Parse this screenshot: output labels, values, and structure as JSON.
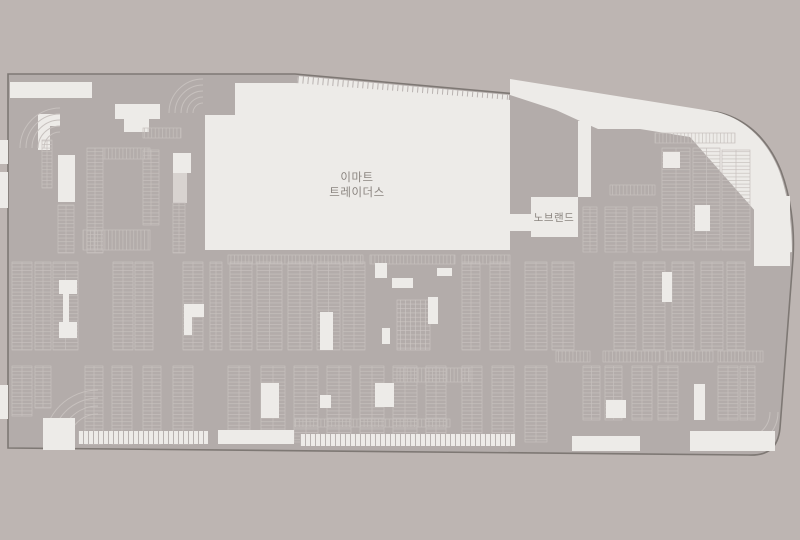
{
  "map": {
    "labels": {
      "store_main_line1": "이마트",
      "store_main_line2": "트레이더스",
      "store_sub": "노브랜드"
    },
    "colors": {
      "background": "#bdb5b2",
      "lot": "#b3acaa",
      "surface_light": "#edebe8",
      "surface_light2": "#d8d3d0",
      "outline": "#7e7874",
      "stall_line": "#c7c1be",
      "tick_line": "#b3acaa",
      "hatch_line": "#cdc7c4",
      "label_text": "#8b8580"
    },
    "geometry": {
      "site_path": "M8,74 L295,74 L717,112 C748,119 769,141 781,171 C790,195 795,226 793,258 L780,428 C778,448 768,456 748,455 L8,448 Z",
      "wedge_path": "M510,79 L717,112 C745,119 766,140 778,168 C787,190 792,222 792,252 L756,258 L756,212 L690,137 L640,129 L598,129 L580,121 L556,110 L510,95 Z",
      "white_base": [
        [
          10,
          82,
          82,
          16
        ],
        [
          754,
          196,
          36,
          70
        ],
        [
          115,
          104,
          45,
          15
        ],
        [
          124,
          117,
          25,
          15
        ],
        [
          38,
          114,
          22,
          12
        ],
        [
          38,
          114,
          12,
          36
        ],
        [
          0,
          140,
          8,
          24
        ],
        [
          0,
          172,
          8,
          36
        ],
        [
          0,
          385,
          8,
          34
        ],
        [
          58,
          155,
          17,
          47
        ],
        [
          173,
          153,
          18,
          20
        ],
        [
          578,
          121,
          13,
          76
        ]
      ],
      "light_shapes": [
        [
          173,
          173,
          14,
          30
        ]
      ],
      "arcs": [
        {
          "cx": 98,
          "cy": 444,
          "radii": [
            30,
            38,
            46,
            54
          ],
          "q": "tl"
        },
        {
          "cx": 203,
          "cy": 113,
          "radii": [
            10,
            16,
            22,
            28,
            34
          ],
          "q": "tl"
        },
        {
          "cx": 60,
          "cy": 148,
          "radii": [
            16,
            22,
            28,
            34,
            40
          ],
          "q": "tl"
        },
        {
          "cx": 744,
          "cy": 412,
          "radii": [
            26,
            34
          ],
          "q": "br"
        }
      ],
      "ladders_v": [
        [
          12,
          262,
          20,
          88
        ],
        [
          35,
          262,
          16,
          88
        ],
        [
          53,
          262,
          25,
          88
        ],
        [
          113,
          262,
          20,
          88
        ],
        [
          135,
          262,
          18,
          88
        ],
        [
          183,
          262,
          20,
          88
        ],
        [
          210,
          262,
          12,
          88
        ],
        [
          230,
          262,
          22,
          88
        ],
        [
          257,
          262,
          25,
          88
        ],
        [
          288,
          262,
          24,
          88
        ],
        [
          317,
          262,
          23,
          88
        ],
        [
          343,
          262,
          22,
          88
        ],
        [
          462,
          262,
          18,
          88
        ],
        [
          490,
          262,
          20,
          88
        ],
        [
          525,
          262,
          22,
          88
        ],
        [
          552,
          262,
          22,
          88
        ],
        [
          614,
          262,
          22,
          88
        ],
        [
          643,
          262,
          22,
          88
        ],
        [
          672,
          262,
          22,
          88
        ],
        [
          701,
          262,
          22,
          88
        ],
        [
          727,
          262,
          18,
          88
        ],
        [
          12,
          366,
          20,
          50
        ],
        [
          35,
          366,
          16,
          42
        ],
        [
          85,
          366,
          18,
          78
        ],
        [
          112,
          366,
          20,
          78
        ],
        [
          143,
          366,
          18,
          78
        ],
        [
          173,
          366,
          20,
          78
        ],
        [
          228,
          366,
          22,
          76
        ],
        [
          261,
          366,
          24,
          76
        ],
        [
          294,
          366,
          24,
          76
        ],
        [
          327,
          366,
          24,
          76
        ],
        [
          360,
          366,
          24,
          76
        ],
        [
          393,
          366,
          24,
          76
        ],
        [
          426,
          366,
          20,
          76
        ],
        [
          462,
          366,
          20,
          76
        ],
        [
          492,
          366,
          22,
          76
        ],
        [
          525,
          366,
          22,
          76
        ],
        [
          583,
          366,
          17,
          54
        ],
        [
          605,
          366,
          17,
          54
        ],
        [
          632,
          366,
          20,
          54
        ],
        [
          658,
          366,
          20,
          54
        ],
        [
          718,
          366,
          20,
          54
        ],
        [
          740,
          366,
          15,
          54
        ],
        [
          42,
          140,
          10,
          48
        ],
        [
          58,
          205,
          16,
          48
        ],
        [
          87,
          148,
          16,
          105
        ],
        [
          143,
          150,
          16,
          75
        ],
        [
          173,
          203,
          12,
          50
        ],
        [
          583,
          207,
          14,
          45
        ],
        [
          605,
          207,
          22,
          45
        ],
        [
          633,
          207,
          24,
          45
        ],
        [
          662,
          148,
          28,
          102
        ],
        [
          693,
          148,
          27,
          102
        ],
        [
          722,
          150,
          28,
          100
        ]
      ],
      "ladders_h": [
        [
          103,
          148,
          47,
          11
        ],
        [
          83,
          230,
          67,
          20
        ],
        [
          143,
          128,
          38,
          10
        ],
        [
          610,
          185,
          45,
          10
        ],
        [
          655,
          133,
          80,
          10
        ],
        [
          295,
          419,
          155,
          8
        ],
        [
          228,
          255,
          135,
          9
        ],
        [
          370,
          255,
          85,
          9
        ],
        [
          462,
          255,
          48,
          9
        ],
        [
          556,
          351,
          34,
          11
        ],
        [
          603,
          351,
          57,
          11
        ],
        [
          665,
          351,
          48,
          11
        ],
        [
          718,
          351,
          45,
          11
        ],
        [
          397,
          368,
          73,
          14
        ]
      ],
      "hatch_blocks": [
        [
          397,
          300,
          33,
          50
        ]
      ],
      "tick_strips": [
        {
          "x": 78,
          "y": 431,
          "w": 130,
          "h": 13,
          "rot": 0
        },
        {
          "x": 300,
          "y": 434,
          "w": 215,
          "h": 12,
          "rot": 0
        },
        {
          "x": 298,
          "y": 76,
          "w": 212,
          "h": 10,
          "rot": 5.15
        }
      ],
      "white_islands": [
        [
          43,
          418,
          32,
          32
        ],
        [
          218,
          430,
          76,
          14
        ],
        [
          572,
          436,
          68,
          15
        ],
        [
          690,
          431,
          85,
          20
        ],
        [
          375,
          263,
          12,
          15
        ],
        [
          392,
          278,
          21,
          10
        ],
        [
          437,
          268,
          15,
          8
        ],
        [
          382,
          328,
          8,
          16
        ],
        [
          59,
          280,
          18,
          14
        ],
        [
          63,
          294,
          6,
          28
        ],
        [
          59,
          322,
          18,
          16
        ],
        [
          184,
          304,
          20,
          13
        ],
        [
          184,
          305,
          8,
          30
        ],
        [
          320,
          312,
          13,
          38
        ],
        [
          428,
          297,
          10,
          27
        ],
        [
          662,
          272,
          10,
          30
        ],
        [
          606,
          400,
          20,
          18
        ],
        [
          694,
          384,
          11,
          36
        ],
        [
          261,
          383,
          18,
          35
        ],
        [
          375,
          383,
          19,
          24
        ],
        [
          320,
          395,
          11,
          13
        ],
        [
          663,
          152,
          17,
          16
        ],
        [
          695,
          205,
          15,
          26
        ]
      ],
      "building_main_path": "M205,115 L235,115 L235,83 L295,83 L510,100 L510,250 L205,250 Z",
      "building_sub_rects": [
        [
          505,
          214,
          26,
          17
        ],
        [
          531,
          197,
          47,
          40
        ]
      ]
    }
  }
}
